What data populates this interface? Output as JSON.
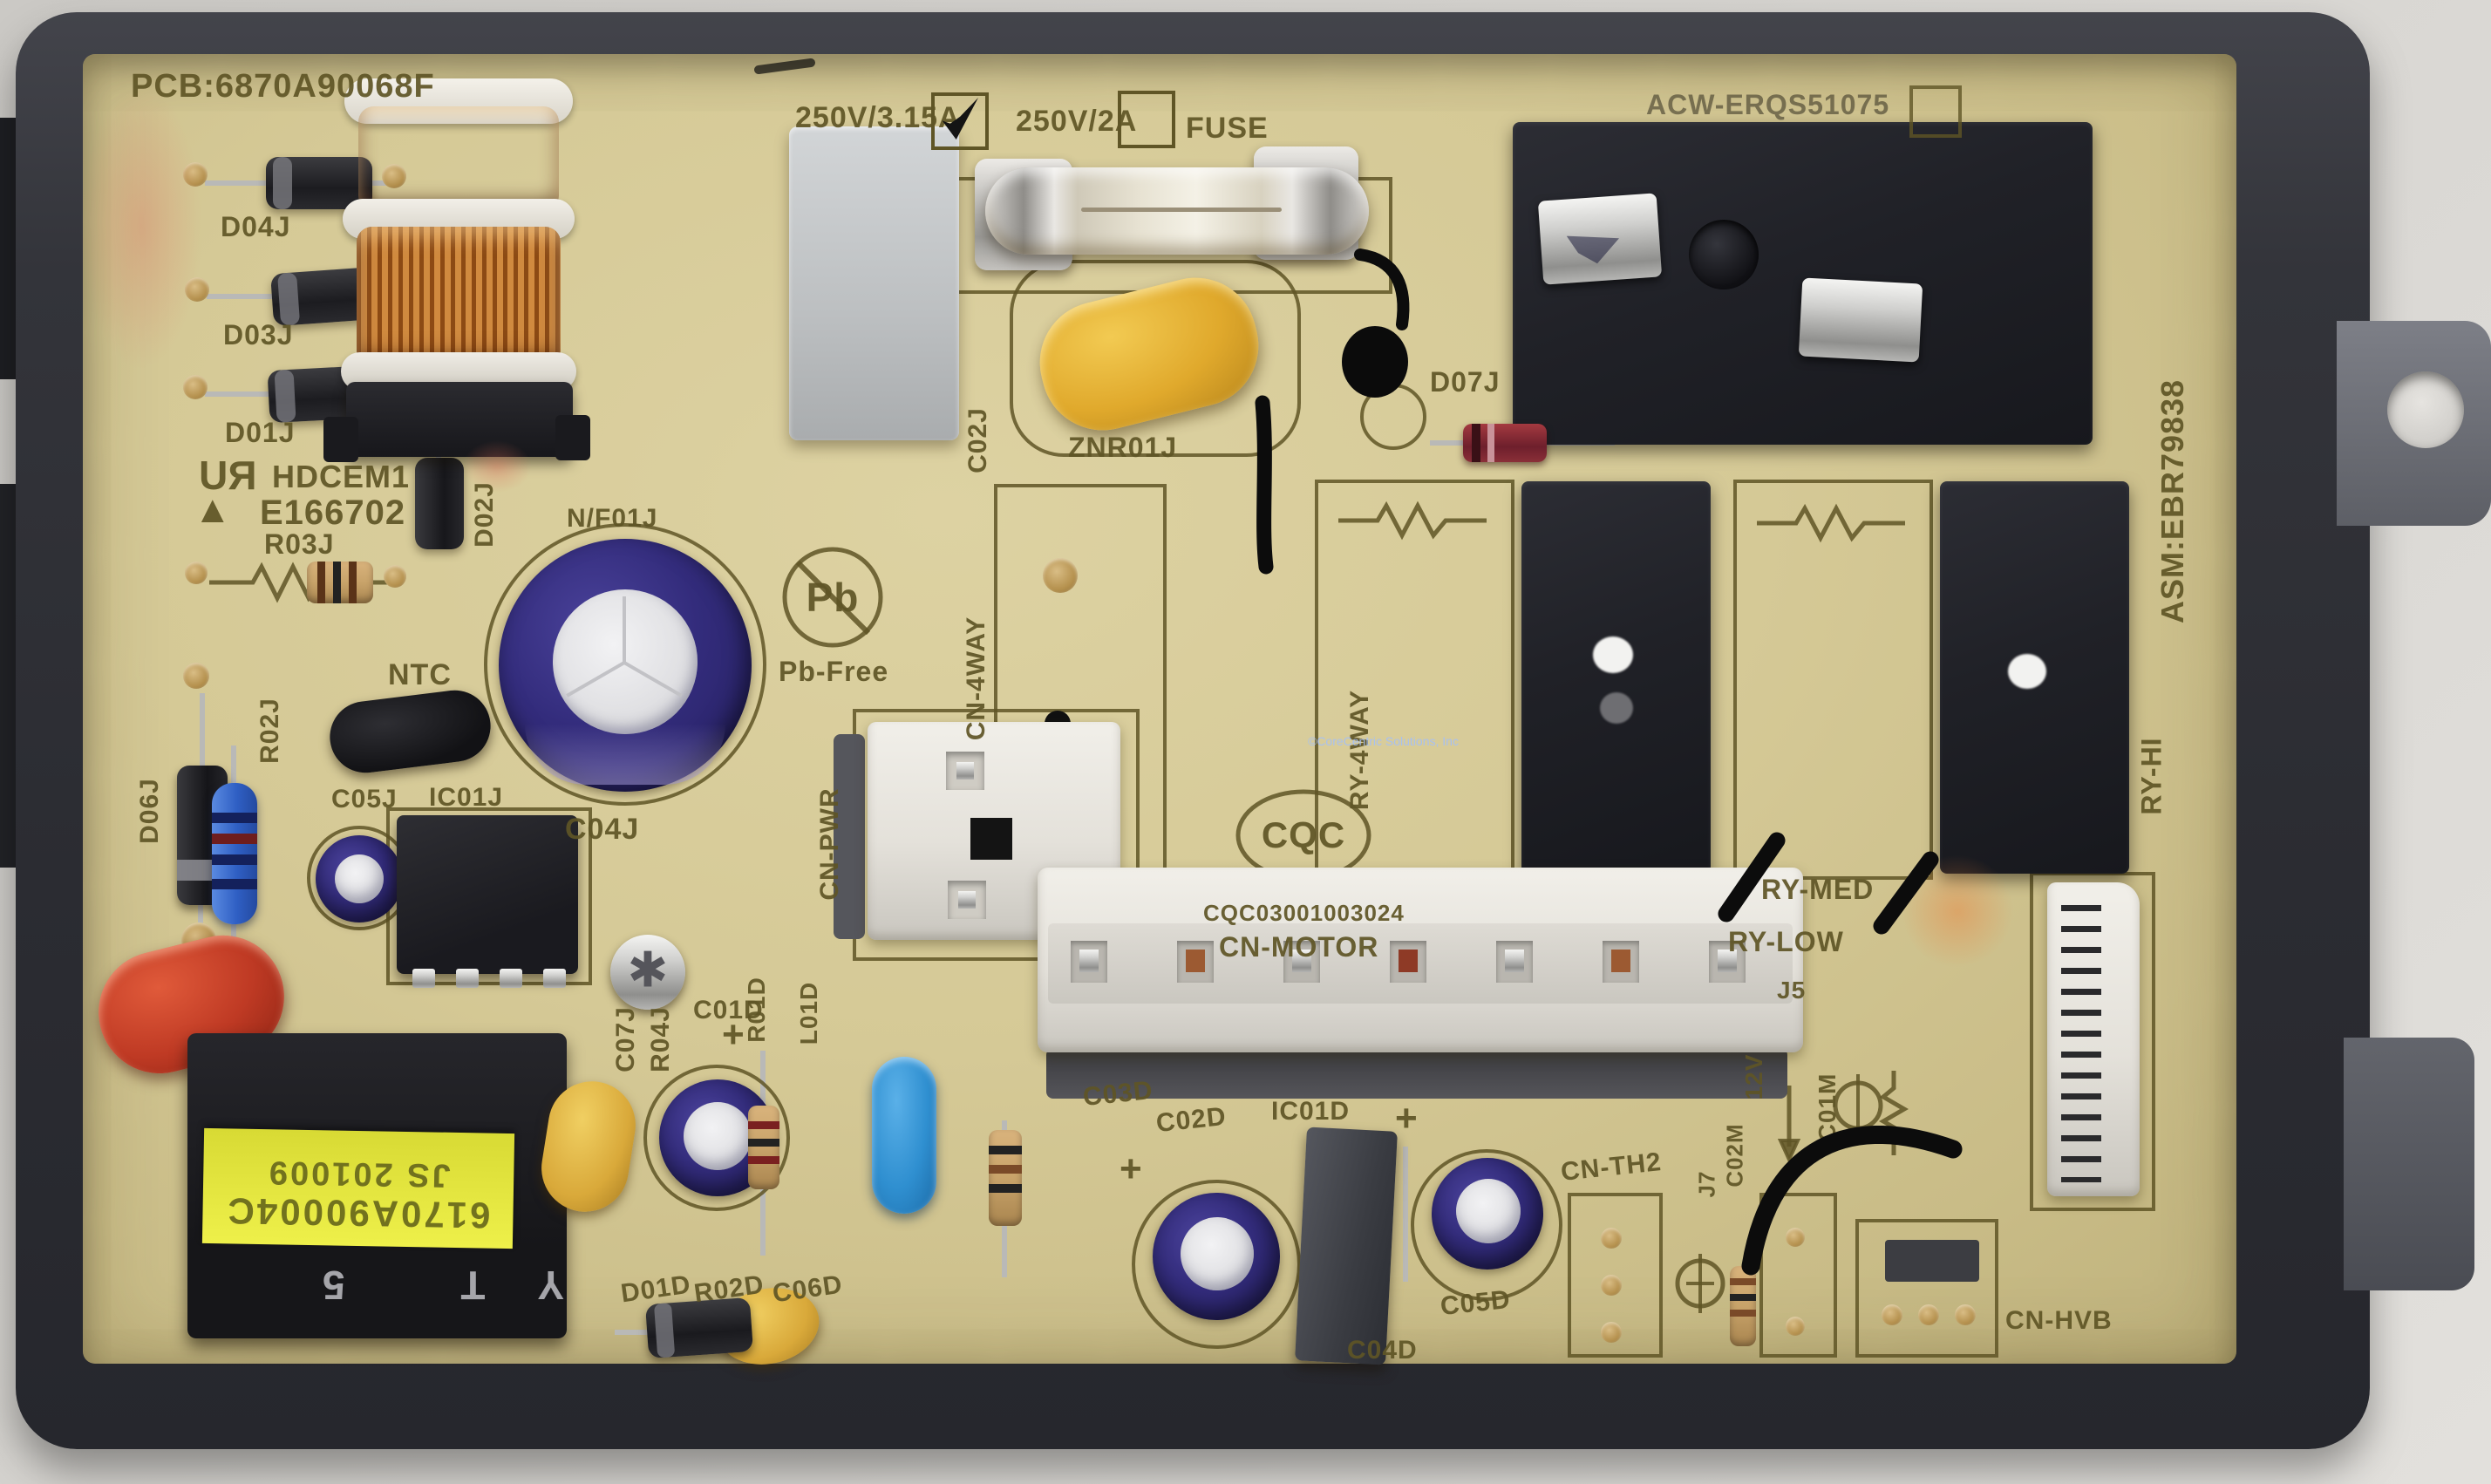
{
  "board": {
    "pcb_number": "PCB:6870A90068F",
    "asm_number": "ASM:EBR79838",
    "relay_part_label": "ACW-ERQS51075",
    "fuse_block": {
      "option1": "250V/3.15A",
      "option1_checked": true,
      "option2": "250V/2A",
      "option2_checked": false,
      "fuse_label": "FUSE"
    },
    "safety_marks": {
      "ul_mark": "RU",
      "ul_code": "HDCEM1",
      "ul_file": "E166702",
      "pb_symbol": "Pb",
      "pb_free": "Pb-Free",
      "cqc_logo": "CQC",
      "cqc_number": "CQC03001003024"
    },
    "sticker": {
      "line1": "6170A90004C",
      "line2": "JS 201009"
    },
    "transformer_marking": "YT 5",
    "connectors": {
      "cn_pwr": "CN-PWR",
      "cn_motor": "CN-MOTOR",
      "cn_4way": "CN-4WAY",
      "cn_th2": "CN-TH2",
      "cn_hvb": "CN-HVB"
    },
    "relay_labels": {
      "ry_4way": "RY-4WAY",
      "ry_low": "RY-LOW",
      "ry_med": "RY-MED",
      "ry_hi": "RY-HI"
    },
    "refdes": {
      "d04j": "D04J",
      "d03j": "D03J",
      "d01j": "D01J",
      "d02j": "D02J",
      "d06j": "D06J",
      "d07j": "D07J",
      "r03j": "R03J",
      "r02j": "R02J",
      "r04j": "R04J",
      "ntc": "NTC",
      "c05j": "C05J",
      "ic01j": "IC01J",
      "c04j": "C04J",
      "c07j": "C07J",
      "c02j": "C02J",
      "znr01j": "ZNR01J",
      "nf01j": "N/F01J",
      "c01d": "C01D",
      "r01d": "R01D",
      "l01d": "L01D",
      "c03d": "C03D",
      "c02d": "C02D",
      "ic01d": "IC01D",
      "c04d": "C04D",
      "c05d": "C05D",
      "c06d": "C06D",
      "d01d": "D01D",
      "r02d": "R02D",
      "j5": "J5",
      "j7": "J7",
      "v12": "12V",
      "c01m": "C01M",
      "c02m": "C02M",
      "plus": "+"
    },
    "watermark": "©CoreCentric Solutions, Inc"
  }
}
